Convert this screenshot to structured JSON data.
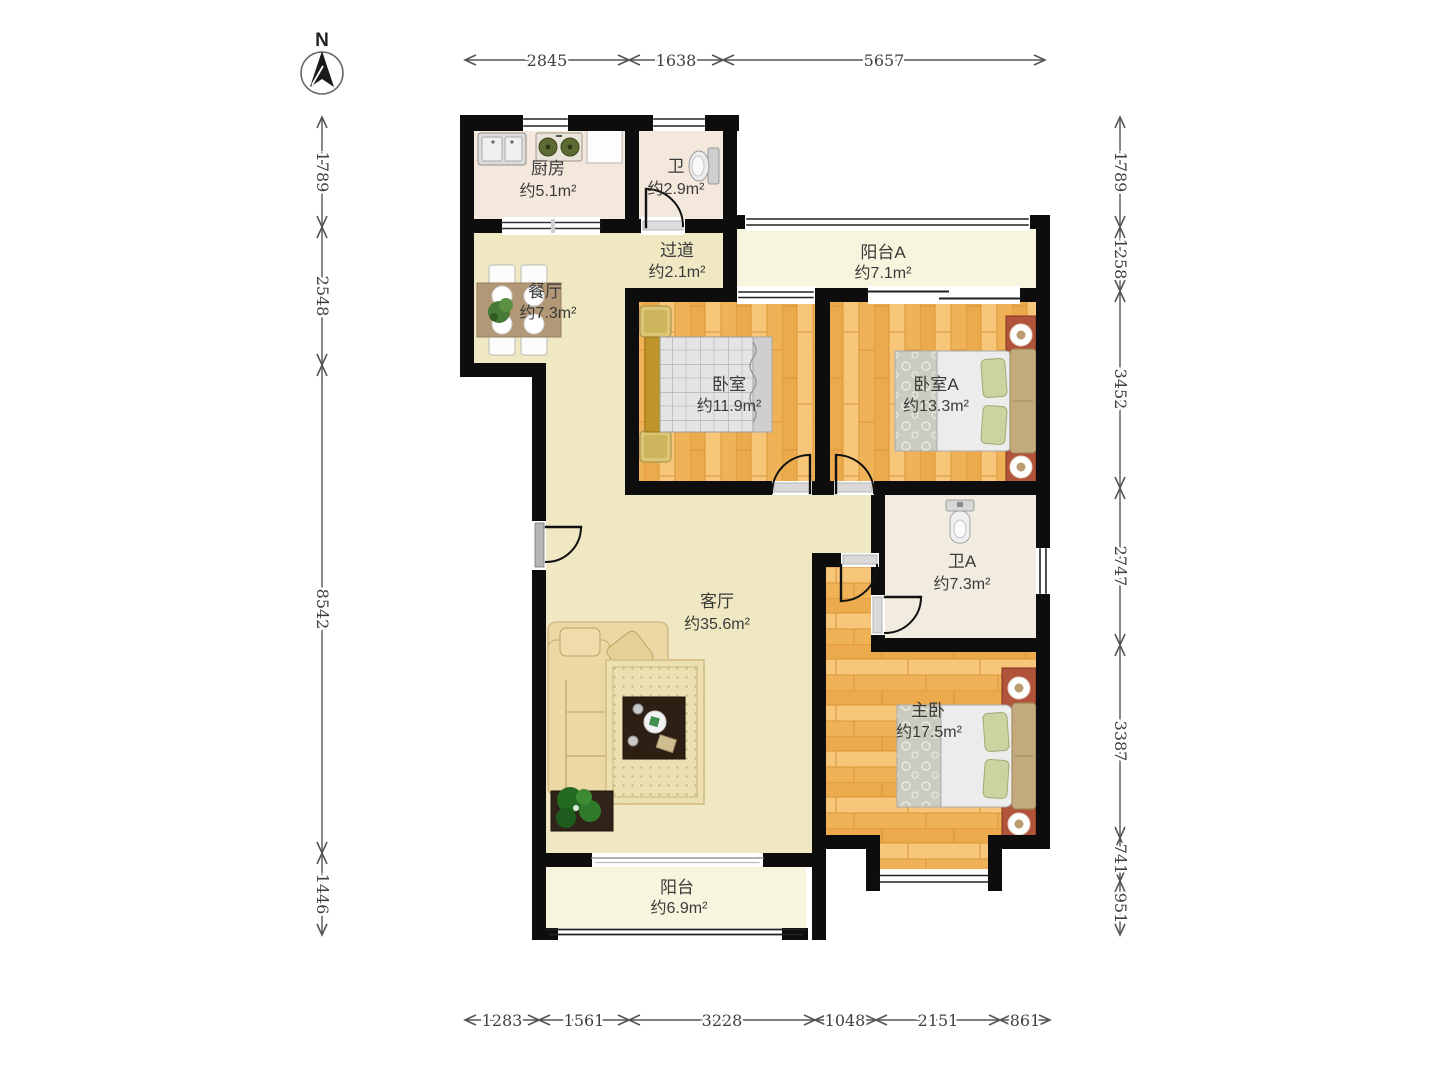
{
  "plan_title": "三室两厅户型图",
  "compass": {
    "label": "N"
  },
  "rooms": {
    "kitchen": {
      "name": "厨房",
      "area": "约5.1m²"
    },
    "bath": {
      "name": "卫",
      "area": "约2.9m²"
    },
    "corridor": {
      "name": "过道",
      "area": "约2.1m²"
    },
    "balcony_a": {
      "name": "阳台A",
      "area": "约7.1m²"
    },
    "dining": {
      "name": "餐厅",
      "area": "约7.3m²"
    },
    "bedroom": {
      "name": "卧室",
      "area": "约11.9m²"
    },
    "bedroom_a": {
      "name": "卧室A",
      "area": "约13.3m²"
    },
    "bath_a": {
      "name": "卫A",
      "area": "约7.3m²"
    },
    "living": {
      "name": "客厅",
      "area": "约35.6m²"
    },
    "master": {
      "name": "主卧",
      "area": "约17.5m²"
    },
    "balcony": {
      "name": "阳台",
      "area": "约6.9m²"
    }
  },
  "dimensions": {
    "unit": "mm",
    "top": [
      "2845",
      "1638",
      "5657"
    ],
    "left": [
      "1789",
      "2548",
      "8542",
      "1446"
    ],
    "right": [
      "1789",
      "1258",
      "3452",
      "2747",
      "3387",
      "741",
      "951"
    ],
    "bottom": [
      "1283",
      "1561",
      "3228",
      "1048",
      "2151",
      "861"
    ]
  },
  "colors": {
    "wall": "#0d0d0d",
    "floor_main": "#efe8c2",
    "floor_kitchen": "#f4e8dc",
    "floor_bath_a": "#f2ebe0",
    "floor_balcony": "#f8f5df",
    "wood": "#f2b65e",
    "dim_line": "#555555",
    "label_text": "#3a3a3a"
  }
}
